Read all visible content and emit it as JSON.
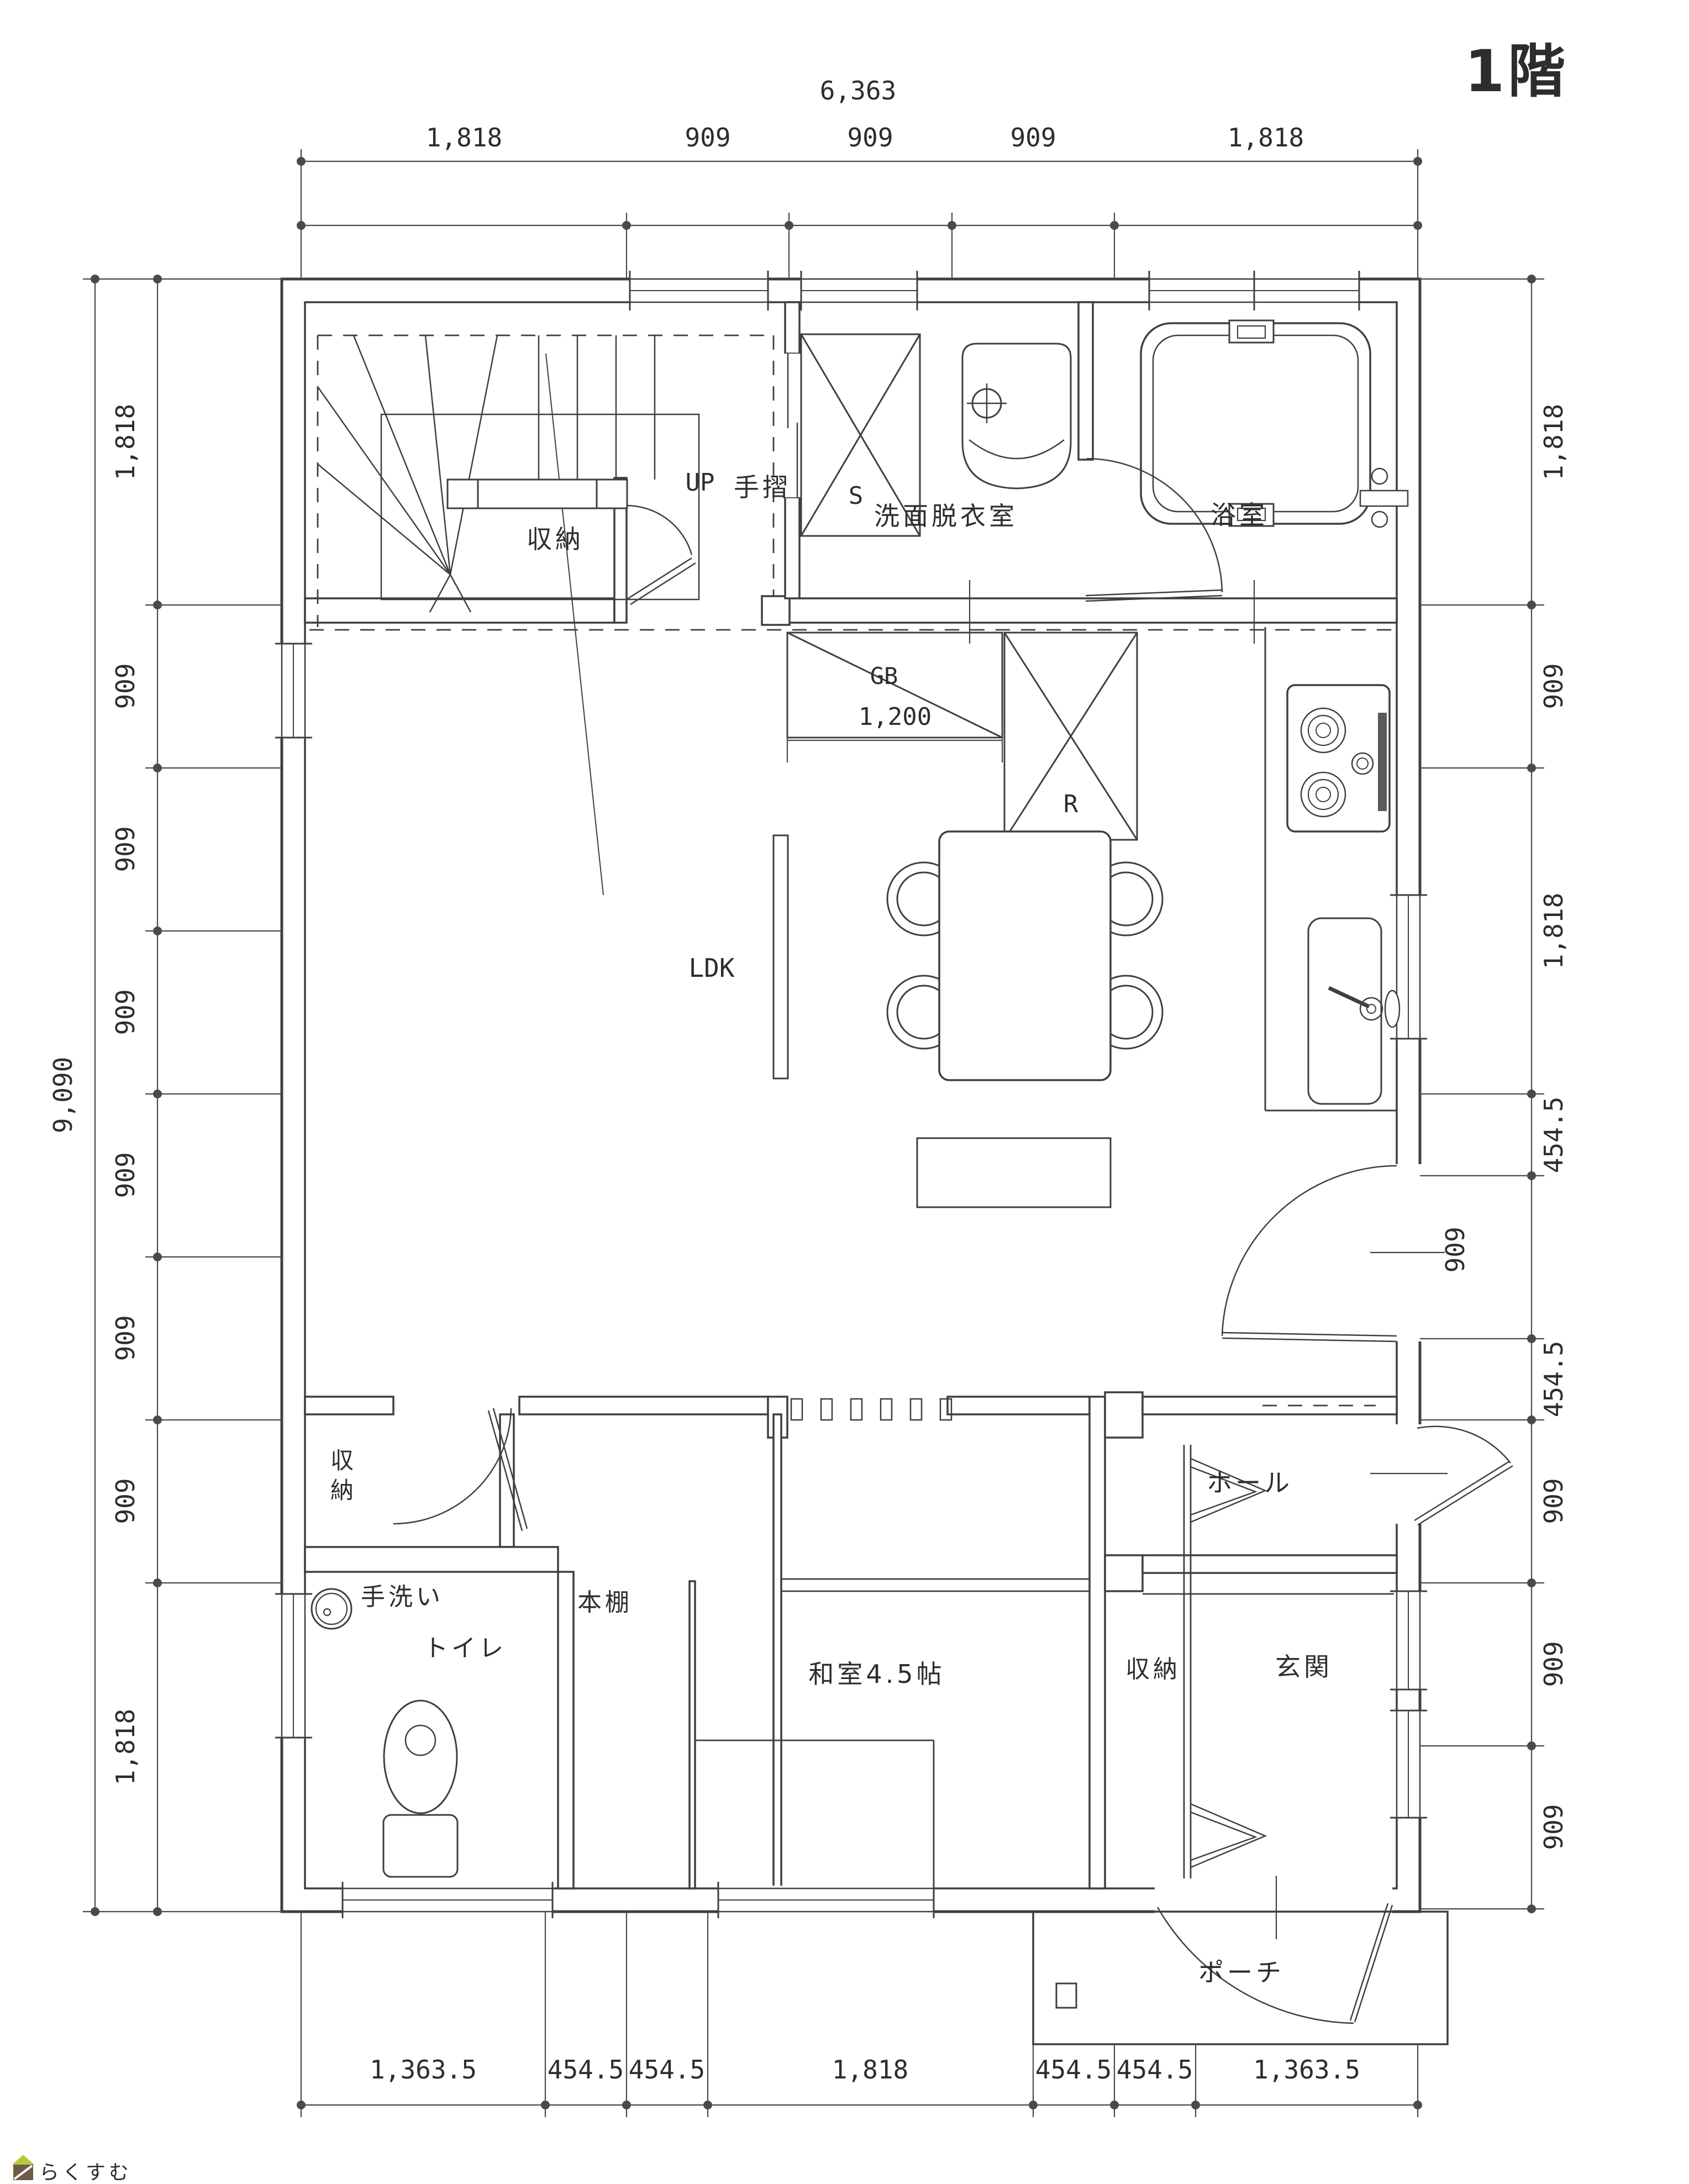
{
  "title": "1階",
  "logo": {
    "text": "らくすむ"
  },
  "rooms": {
    "stair_storage": "収納",
    "up": "UP",
    "handrail": "手摺",
    "washroom": "洗面脱衣室",
    "bath": "浴室",
    "ldk": "LDK",
    "storage_char1": "収",
    "storage_char2": "納",
    "hand_wash": "手洗い",
    "toilet": "トイレ",
    "bookshelf": "本棚",
    "japanese_room": "和室4.5帖",
    "hall": "ホール",
    "entry_storage": "収納",
    "entrance": "玄関",
    "porch": "ポーチ"
  },
  "appliances": {
    "sink_box": "S",
    "gas_counter": "GB",
    "refrigerator": "R"
  },
  "dimensions": {
    "top": {
      "overall": "6,363",
      "segments": [
        "1,818",
        "909",
        "909",
        "909",
        "1,818"
      ]
    },
    "left": {
      "overall": "9,090",
      "segments": [
        "1,818",
        "909",
        "909",
        "909",
        "909",
        "909",
        "909",
        "1,818"
      ]
    },
    "right": {
      "segments": [
        "1,818",
        "909",
        "1,818",
        "454.5",
        "909",
        "454.5",
        "909",
        "909",
        "909"
      ]
    },
    "bottom": {
      "segments": [
        "1,363.5",
        "454.5",
        "454.5",
        "1,818",
        "454.5",
        "454.5",
        "1,363.5"
      ]
    },
    "counter_width": "1,200"
  }
}
